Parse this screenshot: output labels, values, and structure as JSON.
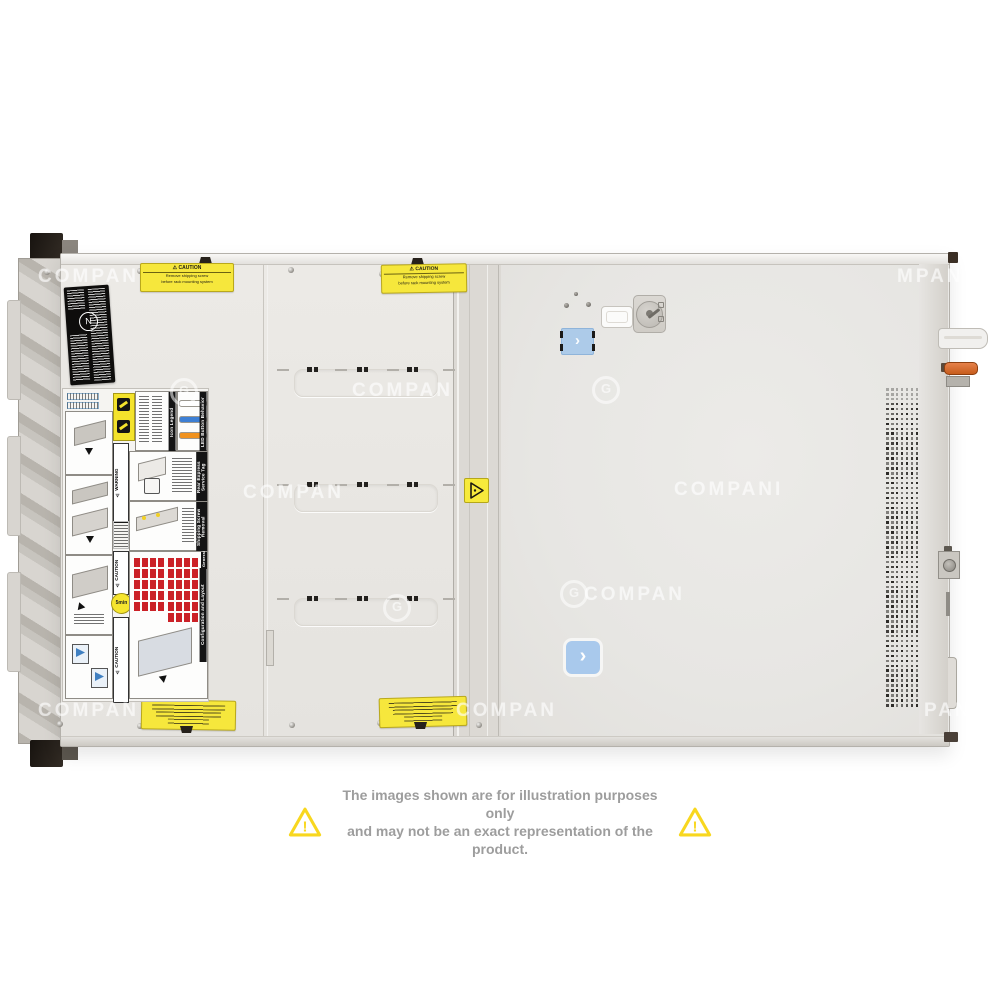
{
  "product": {
    "description": "Rack server top view product photo",
    "chassis_color": "#e9e8e5",
    "accent_latch_color": "#a9c9ec",
    "psu_handle_color": "#c75d1d"
  },
  "icons": {
    "chevron": "›",
    "warning_triangle": "!",
    "lock_key_dial": "keylock-dial",
    "certification_emblem": "N"
  },
  "watermark": {
    "text": "COMPAN",
    "logo_glyph": "G",
    "instances": [
      {
        "x": 38,
        "y": 266,
        "t": "COMPAN"
      },
      {
        "x": 897,
        "y": 266,
        "t": "MPAN"
      },
      {
        "x": 170,
        "y": 378,
        "logo": true
      },
      {
        "x": 352,
        "y": 380,
        "t": "COMPAN"
      },
      {
        "x": 592,
        "y": 376,
        "logo": true
      },
      {
        "x": 243,
        "y": 482,
        "t": "COMPAN"
      },
      {
        "x": 674,
        "y": 479,
        "t": "COMPANI"
      },
      {
        "x": 560,
        "y": 580,
        "logo": true
      },
      {
        "x": 584,
        "y": 584,
        "t": "COMPAN"
      },
      {
        "x": 383,
        "y": 594,
        "logo": true
      },
      {
        "x": 38,
        "y": 700,
        "t": "COMPAN"
      },
      {
        "x": 456,
        "y": 700,
        "t": "COMPAN"
      },
      {
        "x": 924,
        "y": 700,
        "t": "PAN"
      }
    ]
  },
  "stickers": {
    "caution_heading": "⚠ CAUTION",
    "caution_line1": "Remove shipping screw",
    "caution_line2": "before rack mounting system",
    "bottom_stickers_legible": false
  },
  "service_labels": {
    "headers": [
      "Icon Legend",
      "LED Button Behavior",
      "Rear Express Service Tag",
      "Shipping Screw Removal",
      "Configuration and Layout",
      "General"
    ],
    "warning_heading": "⚠ WARNING",
    "caution_heading": "⚠ CAUTION",
    "five_min": "5min",
    "led_bar_colors": [
      "#ffffff",
      "#3d7fd4",
      "#f0921e"
    ],
    "drive_grid_color": "#cb2127",
    "config_grids": [
      {
        "cols": 4,
        "rows": 5
      },
      {
        "cols": 4,
        "rows": 6
      }
    ]
  },
  "vent_grid": {
    "cols": 7,
    "rows": 65
  },
  "stamped_rows": {
    "count": 3,
    "tops": [
      369,
      484,
      598
    ]
  },
  "disclaimer": {
    "line1": "The images shown are for illustration purposes only",
    "line2": "and may not be an exact representation of the product.",
    "text_color": "#9d9d9d",
    "triangle_color": "#f8d71f"
  }
}
